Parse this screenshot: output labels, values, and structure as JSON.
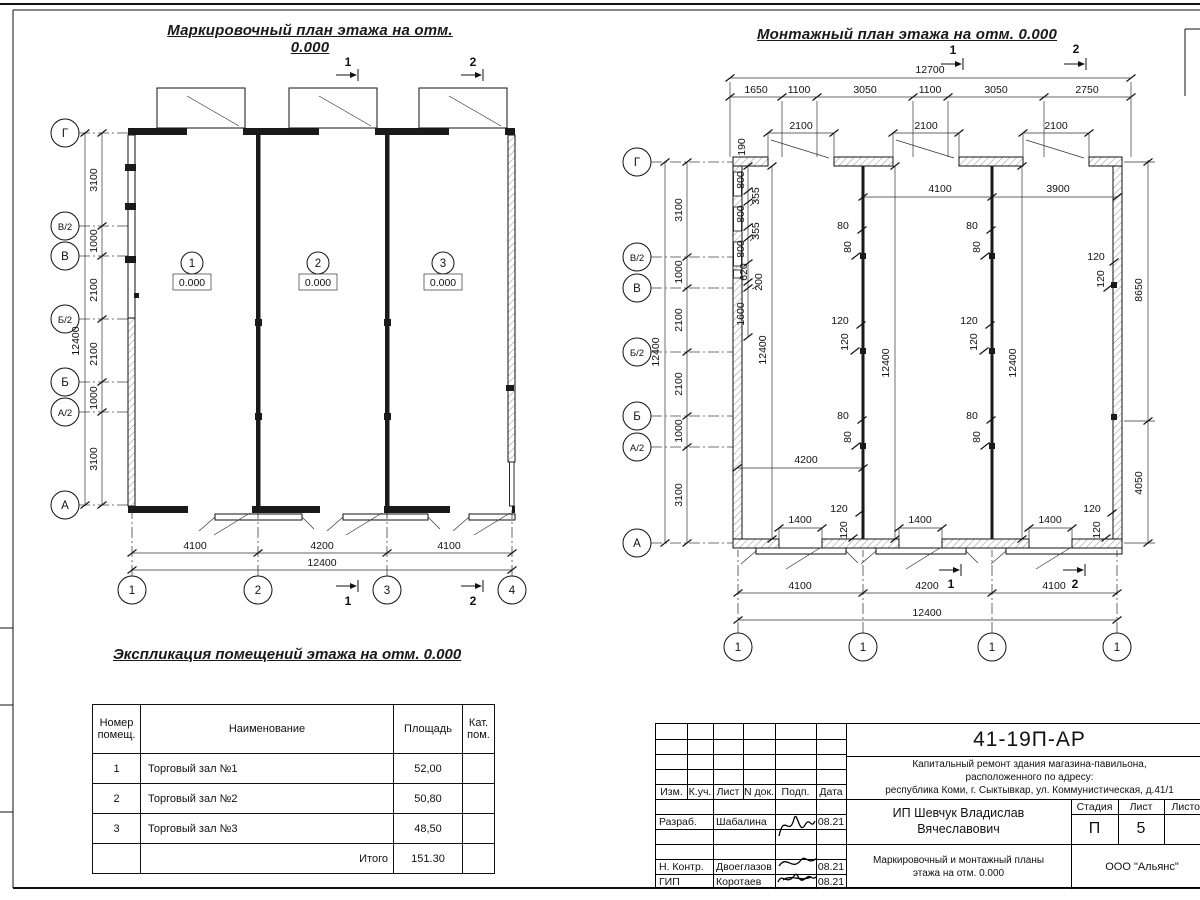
{
  "sheet": {
    "marking_title": "Маркировочный план этажа на отм. 0.000",
    "mounting_title": "Монтажный план этажа на отм. 0.000",
    "explication_title": "Экспликация помещений этажа на отм. 0.000"
  },
  "axes": {
    "rows": [
      "Г",
      "В/2",
      "В",
      "Б/2",
      "Б",
      "А/2",
      "А"
    ],
    "row_dims": [
      "3100",
      "1000",
      "2100",
      "2100",
      "1000",
      "3100"
    ],
    "row_total": "12400"
  },
  "marking": {
    "rooms": [
      {
        "num": "1",
        "elev": "0.000"
      },
      {
        "num": "2",
        "elev": "0.000"
      },
      {
        "num": "3",
        "elev": "0.000"
      }
    ],
    "bottom_dims": [
      "4100",
      "4200",
      "4100"
    ],
    "bottom_total": "12400",
    "bubbles": [
      "1",
      "2",
      "3",
      "4"
    ],
    "section1": "1",
    "section2": "2"
  },
  "mounting": {
    "top_total": "12700",
    "top_dims": [
      "1650",
      "1100",
      "3050",
      "1100",
      "3050",
      "2750"
    ],
    "opening_dim": "2100",
    "parapet_dim": "190",
    "wall_chain": [
      "800",
      "355",
      "800",
      "355",
      "800",
      "620",
      "200",
      "1600"
    ],
    "wall_total": "12400",
    "span_dims": [
      "4100",
      "3900"
    ],
    "bay_total": "12400",
    "d80": "80",
    "d120": "120",
    "door_width": "1400",
    "d4200": "4200",
    "d8650": "8650",
    "d4050": "4050",
    "bottom_dims": [
      "4100",
      "4200",
      "4100"
    ],
    "bottom_total": "12400",
    "bubbles": [
      "1",
      "1",
      "1",
      "1"
    ],
    "section1": "1",
    "section2": "2"
  },
  "explication": {
    "headers": {
      "num": "Номер помещ.",
      "name": "Наименование",
      "area": "Площадь",
      "cat": "Кат. пом."
    },
    "rows": [
      {
        "num": "1",
        "name": "Торговый зал №1",
        "area": "52,00"
      },
      {
        "num": "2",
        "name": "Торговый зал №2",
        "area": "50,80"
      },
      {
        "num": "3",
        "name": "Торговый зал №3",
        "area": "48,50"
      }
    ],
    "total_label": "Итого",
    "total_value": "151.30"
  },
  "title_block": {
    "doc_code": "41-19П-АР",
    "description_line1": "Капитальный ремонт здания магазина-павильона,",
    "description_line2": "расположенного по адресу:",
    "description_line3": "республика Коми, г. Сыктывкар, ул. Коммунистическая, д.41/1",
    "client": "ИП Шевчук Владислав Вячеславович",
    "sheet_title": "Маркировочный и монтажный планы этажа на отм. 0.000",
    "company": "ООО \"Альянс\"",
    "cols": {
      "izm": "Изм.",
      "kuch": "К.уч.",
      "list": "Лист",
      "ndoc": "N док.",
      "podp": "Подп.",
      "data": "Дата"
    },
    "stage_label": "Стадия",
    "sheet_label": "Лист",
    "sheets_label": "Листов",
    "stage_value": "П",
    "sheet_value": "5",
    "roles": [
      {
        "role": "Разраб.",
        "name": "Шабалина",
        "date": "08.21"
      },
      {
        "role": "Н. Контр.",
        "name": "Двоеглазов",
        "date": "08.21"
      },
      {
        "role": "ГИП",
        "name": "Коротаев",
        "date": "08.21"
      }
    ]
  }
}
